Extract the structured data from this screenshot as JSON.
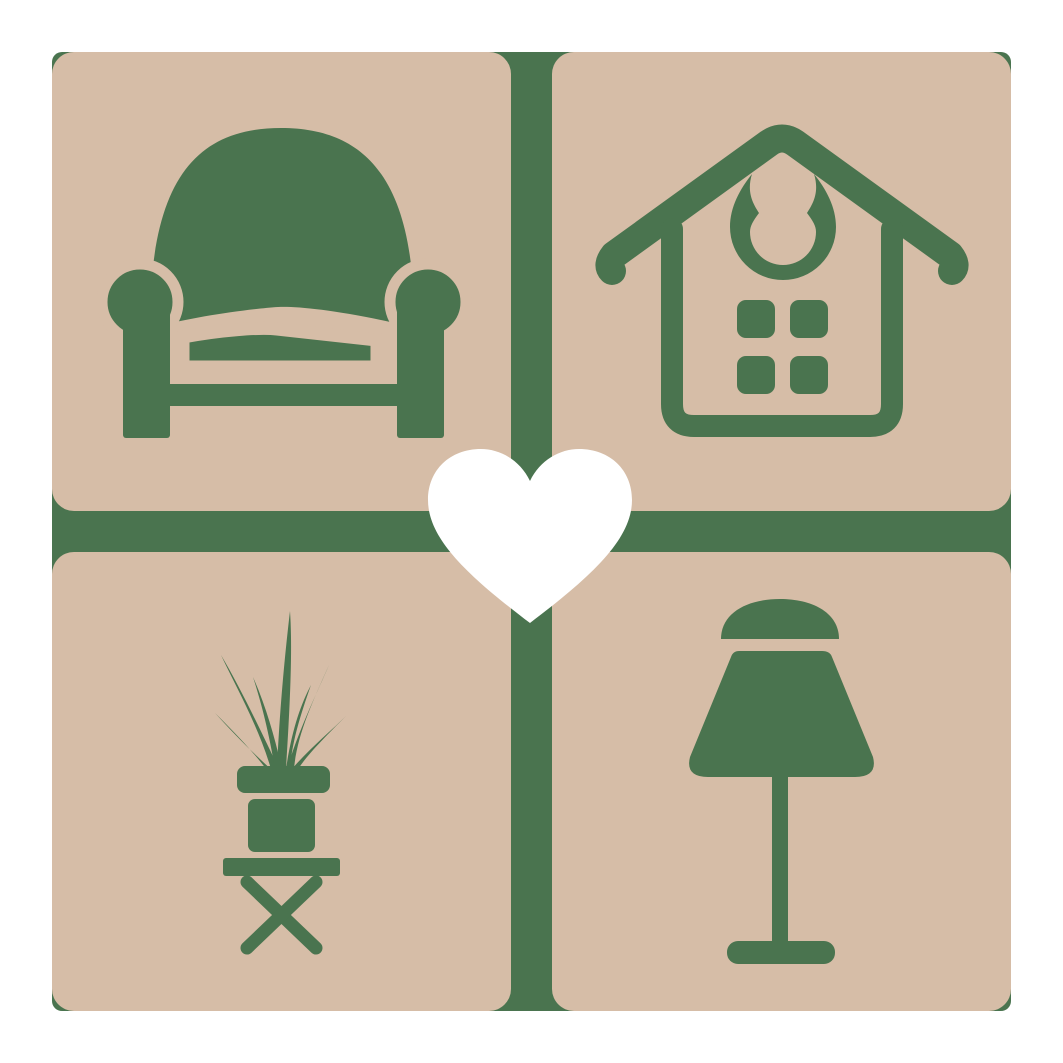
{
  "brand_colors": {
    "green": "#4a744f",
    "beige": "#d6bda7",
    "heart_white": "#ffffff",
    "canvas_white": "#ffffff"
  },
  "logo": {
    "grid": {
      "rows": 2,
      "cols": 2
    },
    "tiles": [
      {
        "position": "top-left",
        "icon": "armchair-icon",
        "subject": "armchair"
      },
      {
        "position": "top-right",
        "icon": "house-icon",
        "subject": "house"
      },
      {
        "position": "bottom-left",
        "icon": "potted-plant-icon",
        "subject": "potted plant on stool"
      },
      {
        "position": "bottom-right",
        "icon": "table-lamp-icon",
        "subject": "table lamp"
      }
    ],
    "center": {
      "icon": "heart-icon",
      "subject": "heart"
    }
  }
}
